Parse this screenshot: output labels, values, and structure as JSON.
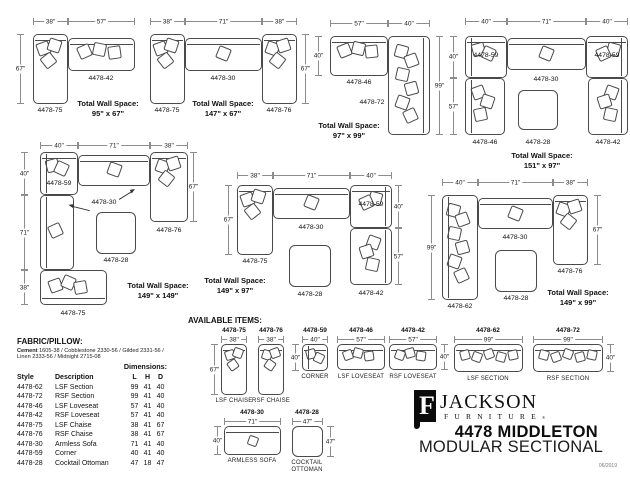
{
  "page": {
    "available_heading": "AVAILABLE ITEMS:",
    "fabric_heading": "FABRIC/PILLOW:",
    "fabric_line1_lead": "Cement",
    "fabric_line1_rest": " 1605-38 / Cobblestone 2330-56 / Gilded 2331-56 /",
    "fabric_line2": "Linen 2333-56 / Midnight 2715-08",
    "date": "06/2019"
  },
  "brand": {
    "mark_letter": "F",
    "name": "JACKSON",
    "sub": "FURNITURE",
    "reg": "®",
    "collection": "4478 MIDDLETON",
    "category": "MODULAR SECTIONAL"
  },
  "table": {
    "dims_heading": "Dimensions:",
    "h_style": "Style",
    "h_desc": "Description",
    "h_l": "L",
    "h_h": "H",
    "h_d": "D",
    "rows": [
      {
        "style": "4478-62",
        "desc": "LSF Section",
        "l": "99",
        "h": "41",
        "d": "40"
      },
      {
        "style": "4478-72",
        "desc": "RSF Section",
        "l": "99",
        "h": "41",
        "d": "40"
      },
      {
        "style": "4478-46",
        "desc": "LSF Loveseat",
        "l": "57",
        "h": "41",
        "d": "40"
      },
      {
        "style": "4478-42",
        "desc": "RSF Loveseat",
        "l": "57",
        "h": "41",
        "d": "40"
      },
      {
        "style": "4478-75",
        "desc": "LSF Chaise",
        "l": "38",
        "h": "41",
        "d": "67"
      },
      {
        "style": "4478-76",
        "desc": "RSF Chaise",
        "l": "38",
        "h": "41",
        "d": "67"
      },
      {
        "style": "4478-30",
        "desc": "Armless Sofa",
        "l": "71",
        "h": "41",
        "d": "40"
      },
      {
        "style": "4478-59",
        "desc": "Corner",
        "l": "40",
        "h": "41",
        "d": "40"
      },
      {
        "style": "4478-28",
        "desc": "Cocktail Ottoman",
        "l": "47",
        "h": "18",
        "d": "47"
      }
    ]
  },
  "configs": [
    {
      "t1": "38\"",
      "t2": "57\"",
      "l1": "67\"",
      "pa": "4478-75",
      "pb": "4478-42",
      "total_label": "Total Wall Space:",
      "total_size": "95\" x 67\""
    },
    {
      "t1": "38\"",
      "t2": "71\"",
      "t3": "38\"",
      "r1": "67\"",
      "pa": "4478-75",
      "pb": "4478-30",
      "pc": "4478-76",
      "total_label": "Total Wall Space:",
      "total_size": "147\" x 67\""
    },
    {
      "t1": "57\"",
      "t2": "40\"",
      "l1": "40\"",
      "r1": "99\"",
      "pa": "4478-46",
      "pb": "4478-72",
      "total_label": "Total Wall Space:",
      "total_size": "97\" x 99\""
    },
    {
      "t1": "40\"",
      "t2": "71\"",
      "t3": "40\"",
      "l1": "40\"",
      "l2": "57\"",
      "pa": "4478-59",
      "pb": "4478-30",
      "pc": "4478-59",
      "pd": "4478-46",
      "pe": "4478-28",
      "pf": "4478-42",
      "total_label": "Total Wall Space:",
      "total_size": "151\" x 97\""
    },
    {
      "t1": "40\"",
      "t2": "71\"",
      "t3": "38\"",
      "l1": "40\"",
      "l2": "71\"",
      "l3": "38\"",
      "r1": "67\"",
      "pa": "4478-59",
      "pb": "4478-30",
      "pc": "4478-76",
      "pd": "4478-75",
      "pe": "4478-28",
      "total_label": "Total Wall Space:",
      "total_size": "149\" x 149\""
    },
    {
      "t1": "38\"",
      "t2": "71\"",
      "t3": "40\"",
      "l1": "67\"",
      "r1": "40\"",
      "r2": "57\"",
      "pa": "4478-75",
      "pb": "4478-30",
      "pc": "4478-59",
      "pd": "4478-42",
      "pe": "4478-28",
      "total_label": "Total Wall Space:",
      "total_size": "149\" x 97\""
    },
    {
      "t1": "40\"",
      "t2": "71\"",
      "t3": "38\"",
      "l1": "99\"",
      "r1": "67\"",
      "pa": "4478-62",
      "pb": "4478-30",
      "pc": "4478-76",
      "pd": "4478-28",
      "total_label": "Total Wall Space:",
      "total_size": "149\" x 99\""
    }
  ],
  "items": [
    {
      "code": "4478-75",
      "w": "38\"",
      "side": "67\"",
      "name": "LSF CHAISE"
    },
    {
      "code": "4478-76",
      "w": "38\"",
      "name": "RSF CHAISE"
    },
    {
      "code": "4478-59",
      "w": "40\"",
      "side": "40\"",
      "name": "CORNER"
    },
    {
      "code": "4478-46",
      "w": "57\"",
      "name": "LSF LOVESEAT"
    },
    {
      "code": "4478-42",
      "w": "57\"",
      "side": "40\"",
      "name": "RSF LOVESEAT"
    },
    {
      "code": "4478-62",
      "w": "99\"",
      "name": "LSF SECTION"
    },
    {
      "code": "4478-72",
      "w": "99\"",
      "side": "40\"",
      "name": "RSF SECTION"
    },
    {
      "code": "4478-30",
      "w": "71\"",
      "side": "40\"",
      "name": "ARMLESS SOFA"
    },
    {
      "code": "4478-28",
      "w": "47\"",
      "side": "47\"",
      "name": "COCKTAIL",
      "name2": "OTTOMAN"
    }
  ]
}
